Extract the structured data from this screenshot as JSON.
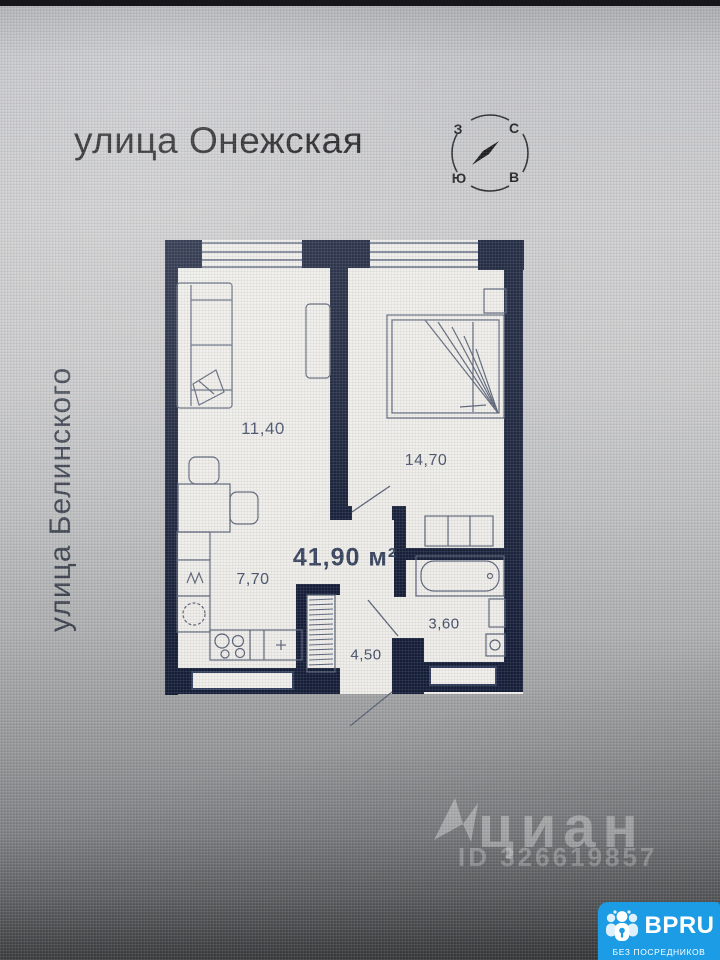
{
  "header": {
    "street_top": "улица Онежская",
    "street_left": "улица Белинского"
  },
  "compass": {
    "west": "З",
    "north": "С",
    "south": "Ю",
    "east": "В",
    "needle_direction": "north-east"
  },
  "plan": {
    "total_area": "41,90 м²",
    "rooms": [
      {
        "name": "living-room",
        "area": "11,40"
      },
      {
        "name": "bedroom",
        "area": "14,70"
      },
      {
        "name": "kitchen",
        "area": "7,70"
      },
      {
        "name": "bathroom",
        "area": "3,60"
      },
      {
        "name": "hallway",
        "area": "4,50"
      }
    ]
  },
  "watermark": {
    "brand": "циан",
    "listing_id": "ID 326619857"
  },
  "badge": {
    "brand": "BPRU",
    "tagline": "БЕЗ ПОСРЕДНИКОВ",
    "color": "#1b9ce4",
    "icon": "people-group-icon"
  },
  "colors": {
    "wall": "#17203a",
    "window_line": "#33405e",
    "furniture_line": "#5a6378",
    "floor": "#eeede9",
    "accent_blue": "#1b9ce4"
  }
}
